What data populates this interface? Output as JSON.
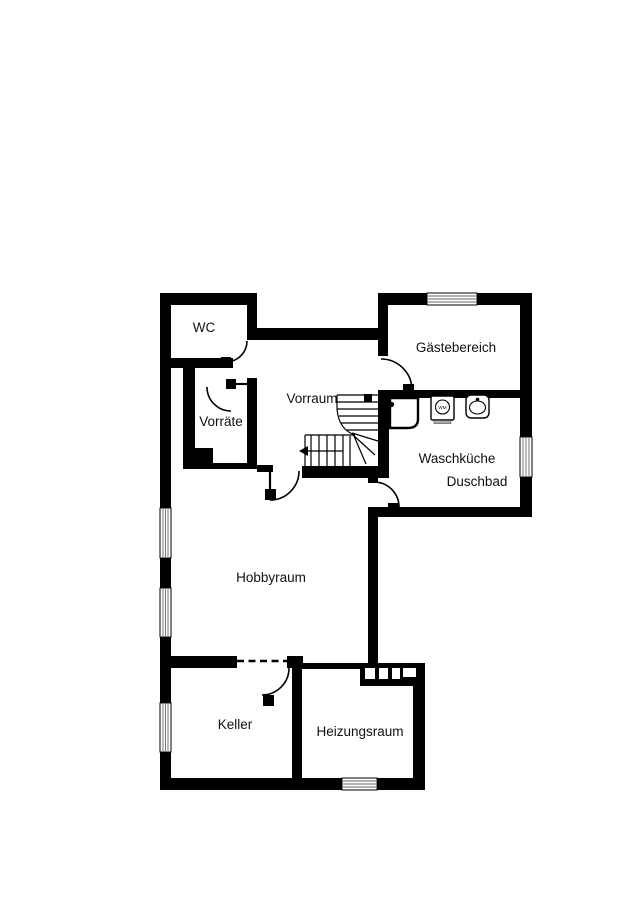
{
  "colors": {
    "wall": "#000000",
    "background": "#ffffff",
    "label": "#111111",
    "window_line": "#666666",
    "appliance_base": "#aaaaaa"
  },
  "rooms": {
    "wc": "WC",
    "vorraete": "Vorräte",
    "vorraum": "Vorraum",
    "gaestebereich": "Gästebereich",
    "waschkueche": "Waschküche",
    "duschbad": "Duschbad",
    "hobbyraum": "Hobbyraum",
    "keller": "Keller",
    "heizungsraum": "Heizungsraum"
  },
  "appliances": {
    "washing_machine_label": "WM"
  }
}
